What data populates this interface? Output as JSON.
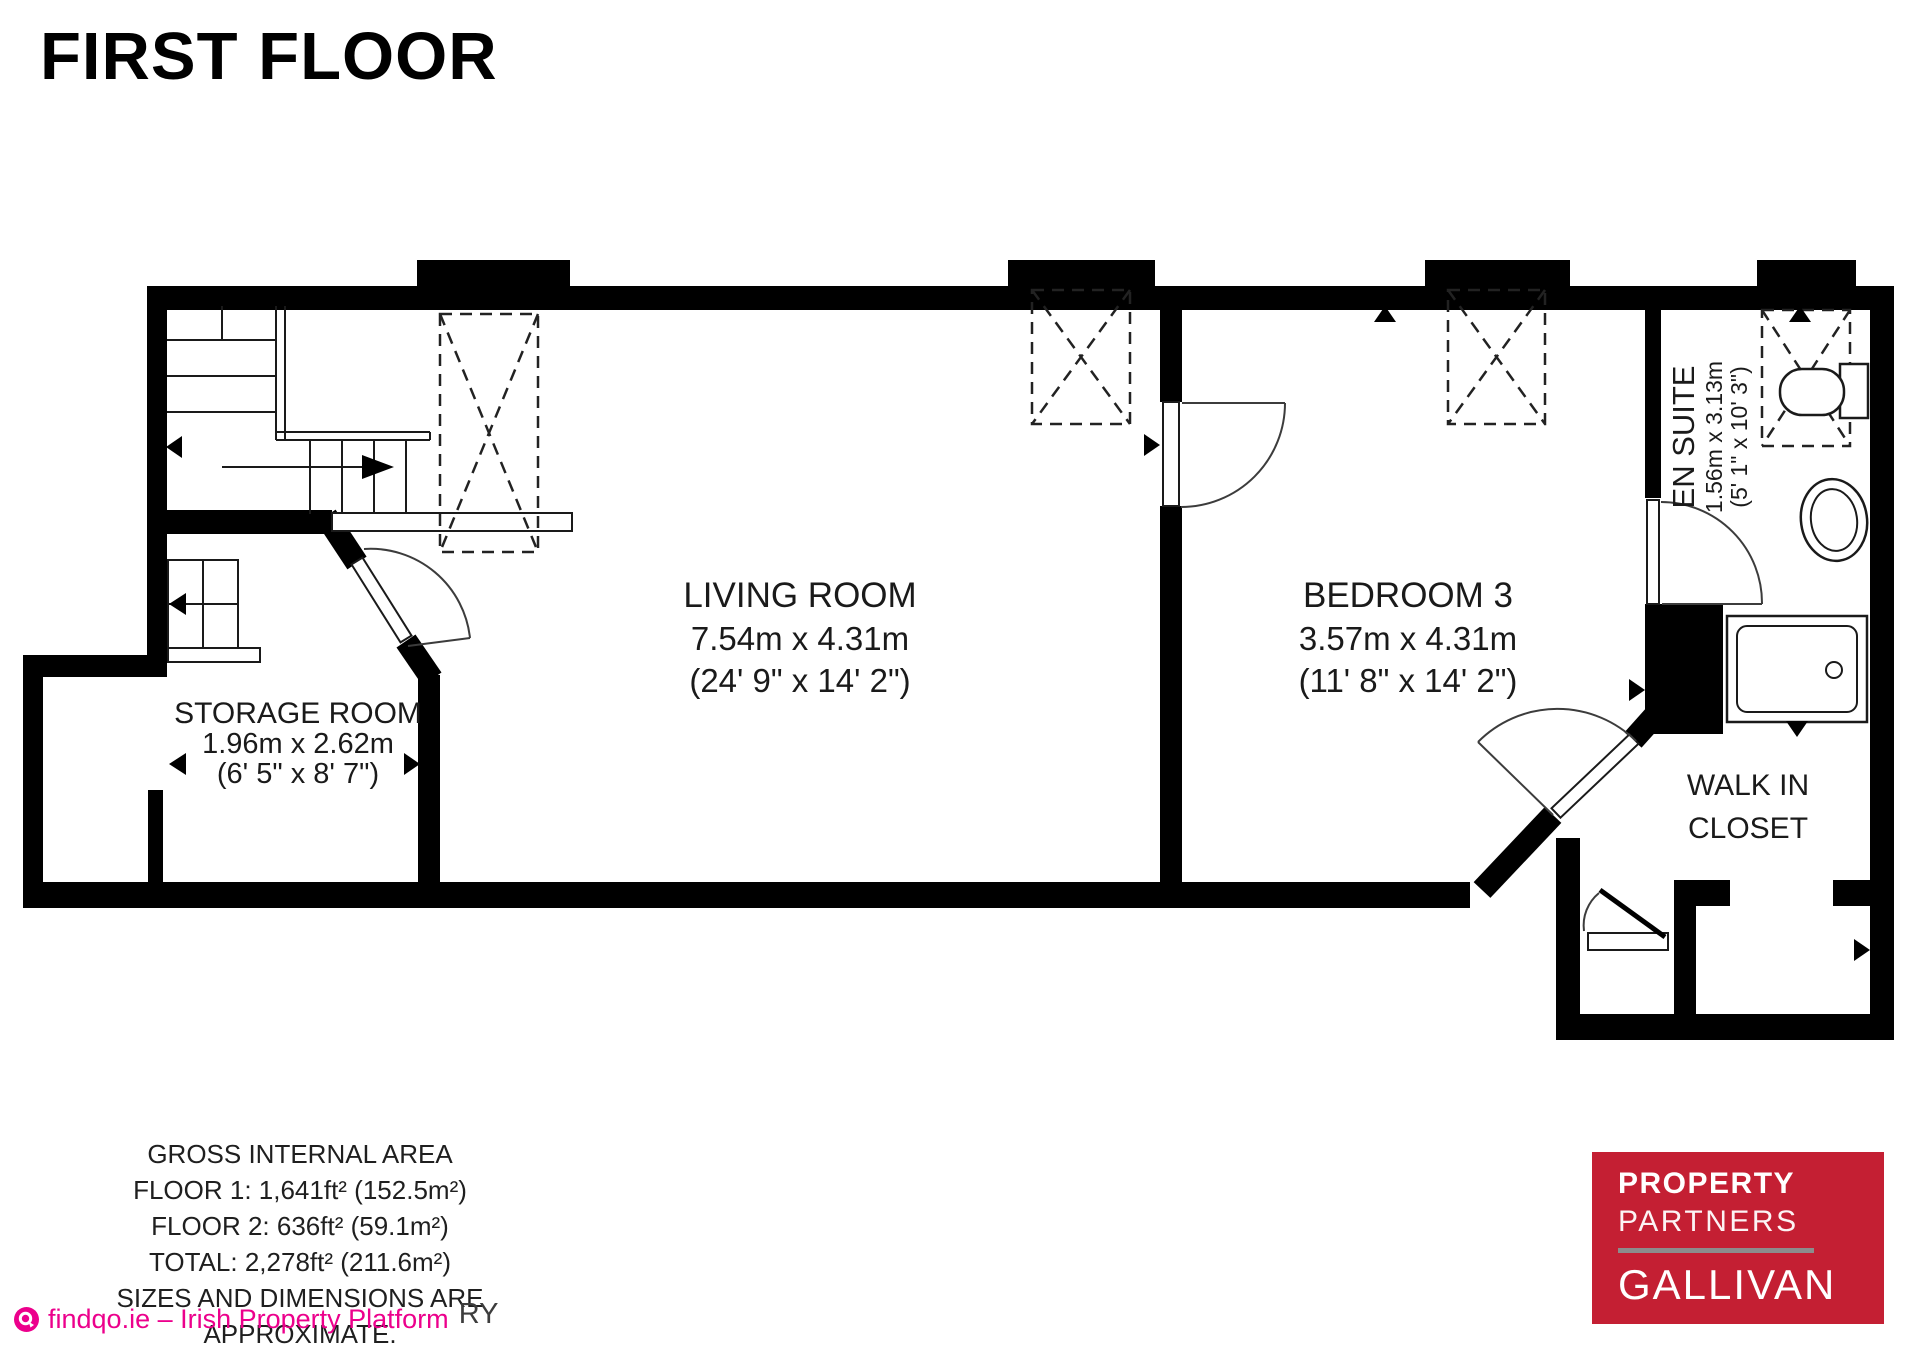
{
  "title": "FIRST FLOOR",
  "rooms": [
    {
      "id": "living-room",
      "name": "LIVING ROOM",
      "metric": "7.54m x 4.31m",
      "imperial": "(24' 9\" x 14' 2\")"
    },
    {
      "id": "bedroom-3",
      "name": "BEDROOM 3",
      "metric": "3.57m x 4.31m",
      "imperial": "(11' 8\" x 14' 2\")"
    },
    {
      "id": "storage-room",
      "name": "STORAGE ROOM",
      "metric": "1.96m x 2.62m",
      "imperial": "(6' 5\" x 8' 7\")"
    },
    {
      "id": "en-suite",
      "name": "EN SUITE",
      "metric": "1.56m x 3.13m",
      "imperial": "(5' 1\" x 10' 3\")"
    },
    {
      "id": "walk-in-closet",
      "name_line1": "WALK IN",
      "name_line2": "CLOSET"
    }
  ],
  "footer": {
    "area_lines": [
      "GROSS INTERNAL AREA",
      "FLOOR 1: 1,641ft² (152.5m²)",
      "FLOOR 2: 636ft² (59.1m²)",
      "TOTAL: 2,278ft² (211.6m²)",
      "SIZES AND DIMENSIONS ARE APPROXIMATE."
    ],
    "watermark_fragment": "RY",
    "platform_text": "findqo.ie – Irish Property Platform"
  },
  "brand": {
    "lines": [
      "PROPERTY",
      "PARTNERS",
      "GALLIVAN"
    ]
  },
  "colors": {
    "plan_ink": "#000000",
    "platform_pink": "#ec008c",
    "brand_red": "#c41f33",
    "brand_rule_gray": "#8c8c8c"
  }
}
